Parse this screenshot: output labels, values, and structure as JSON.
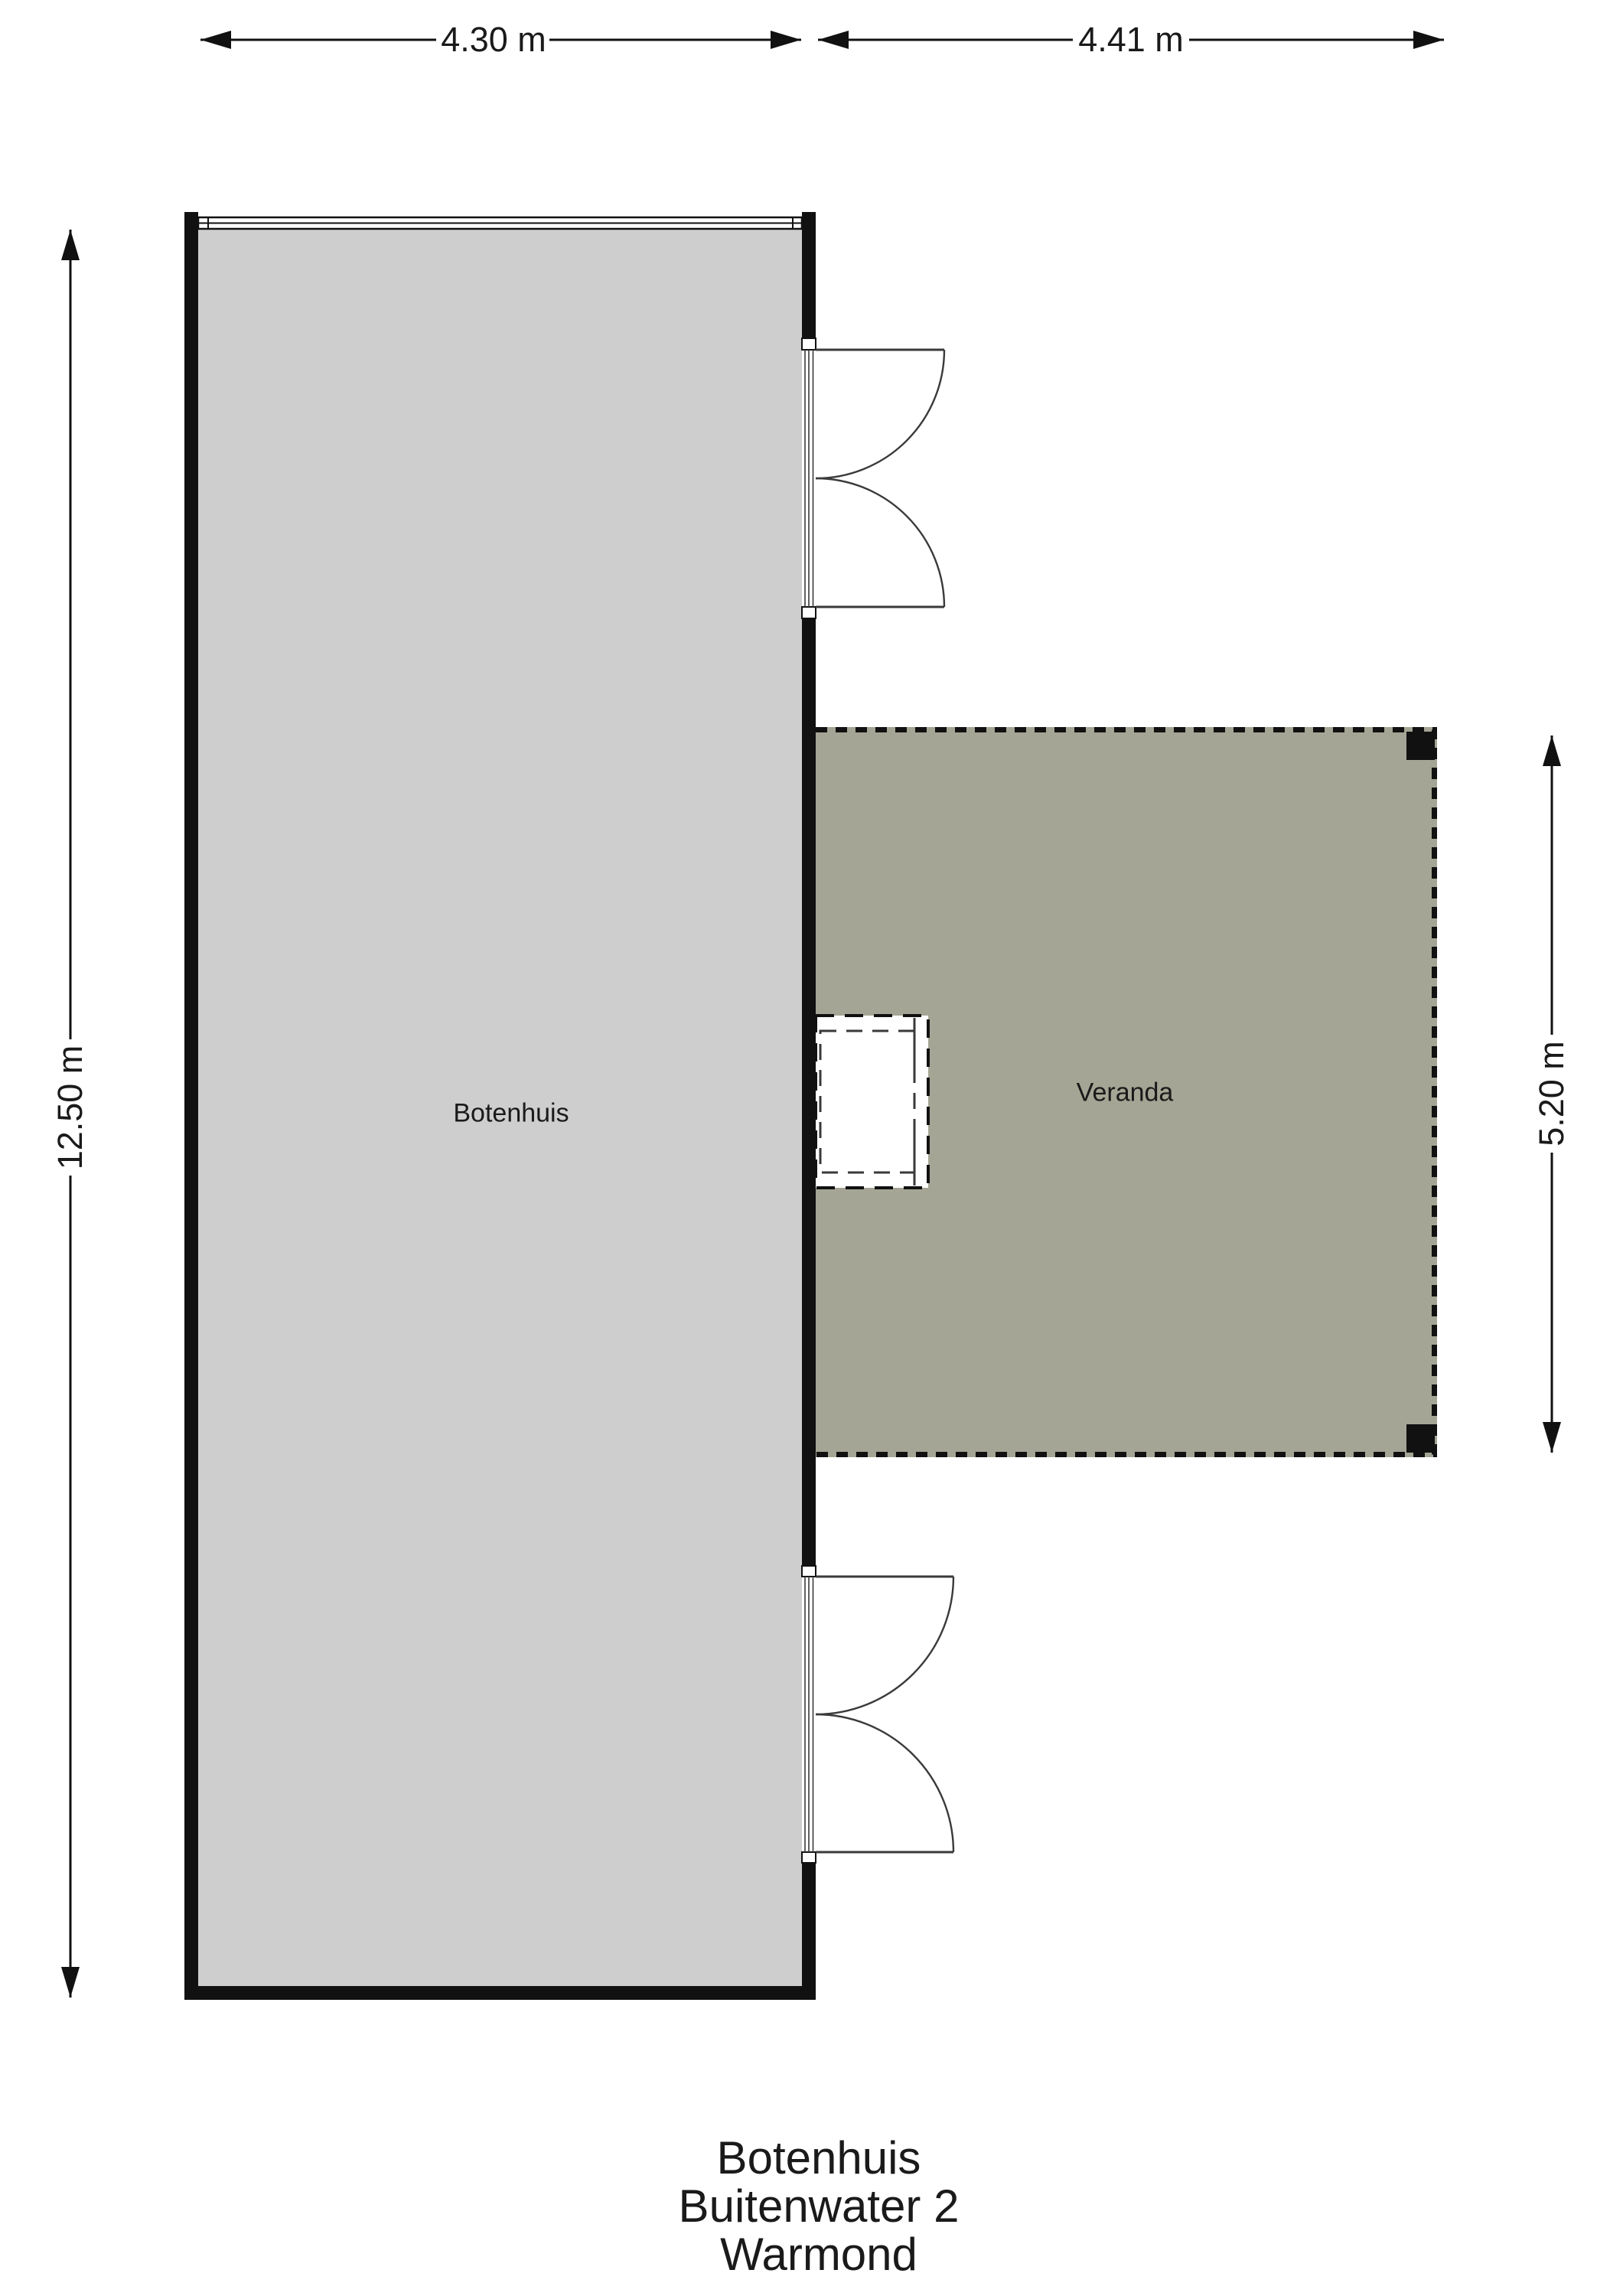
{
  "plan": {
    "rooms": [
      {
        "name": "Botenhuis"
      },
      {
        "name": "Veranda"
      }
    ],
    "dimensions": {
      "top_left": "4.30 m",
      "top_right": "4.41 m",
      "left": "12.50 m",
      "right": "5.20 m"
    }
  },
  "title": {
    "line1": "Botenhuis",
    "line2": "Buitenwater 2",
    "line3": "Warmond"
  },
  "colors": {
    "background": "#ffffff",
    "wall": "#111111",
    "line": "#3a3a3a",
    "text": "#1a1a1a",
    "botenhuis_fill": "#cecece",
    "veranda_fill": "#a5a595"
  }
}
